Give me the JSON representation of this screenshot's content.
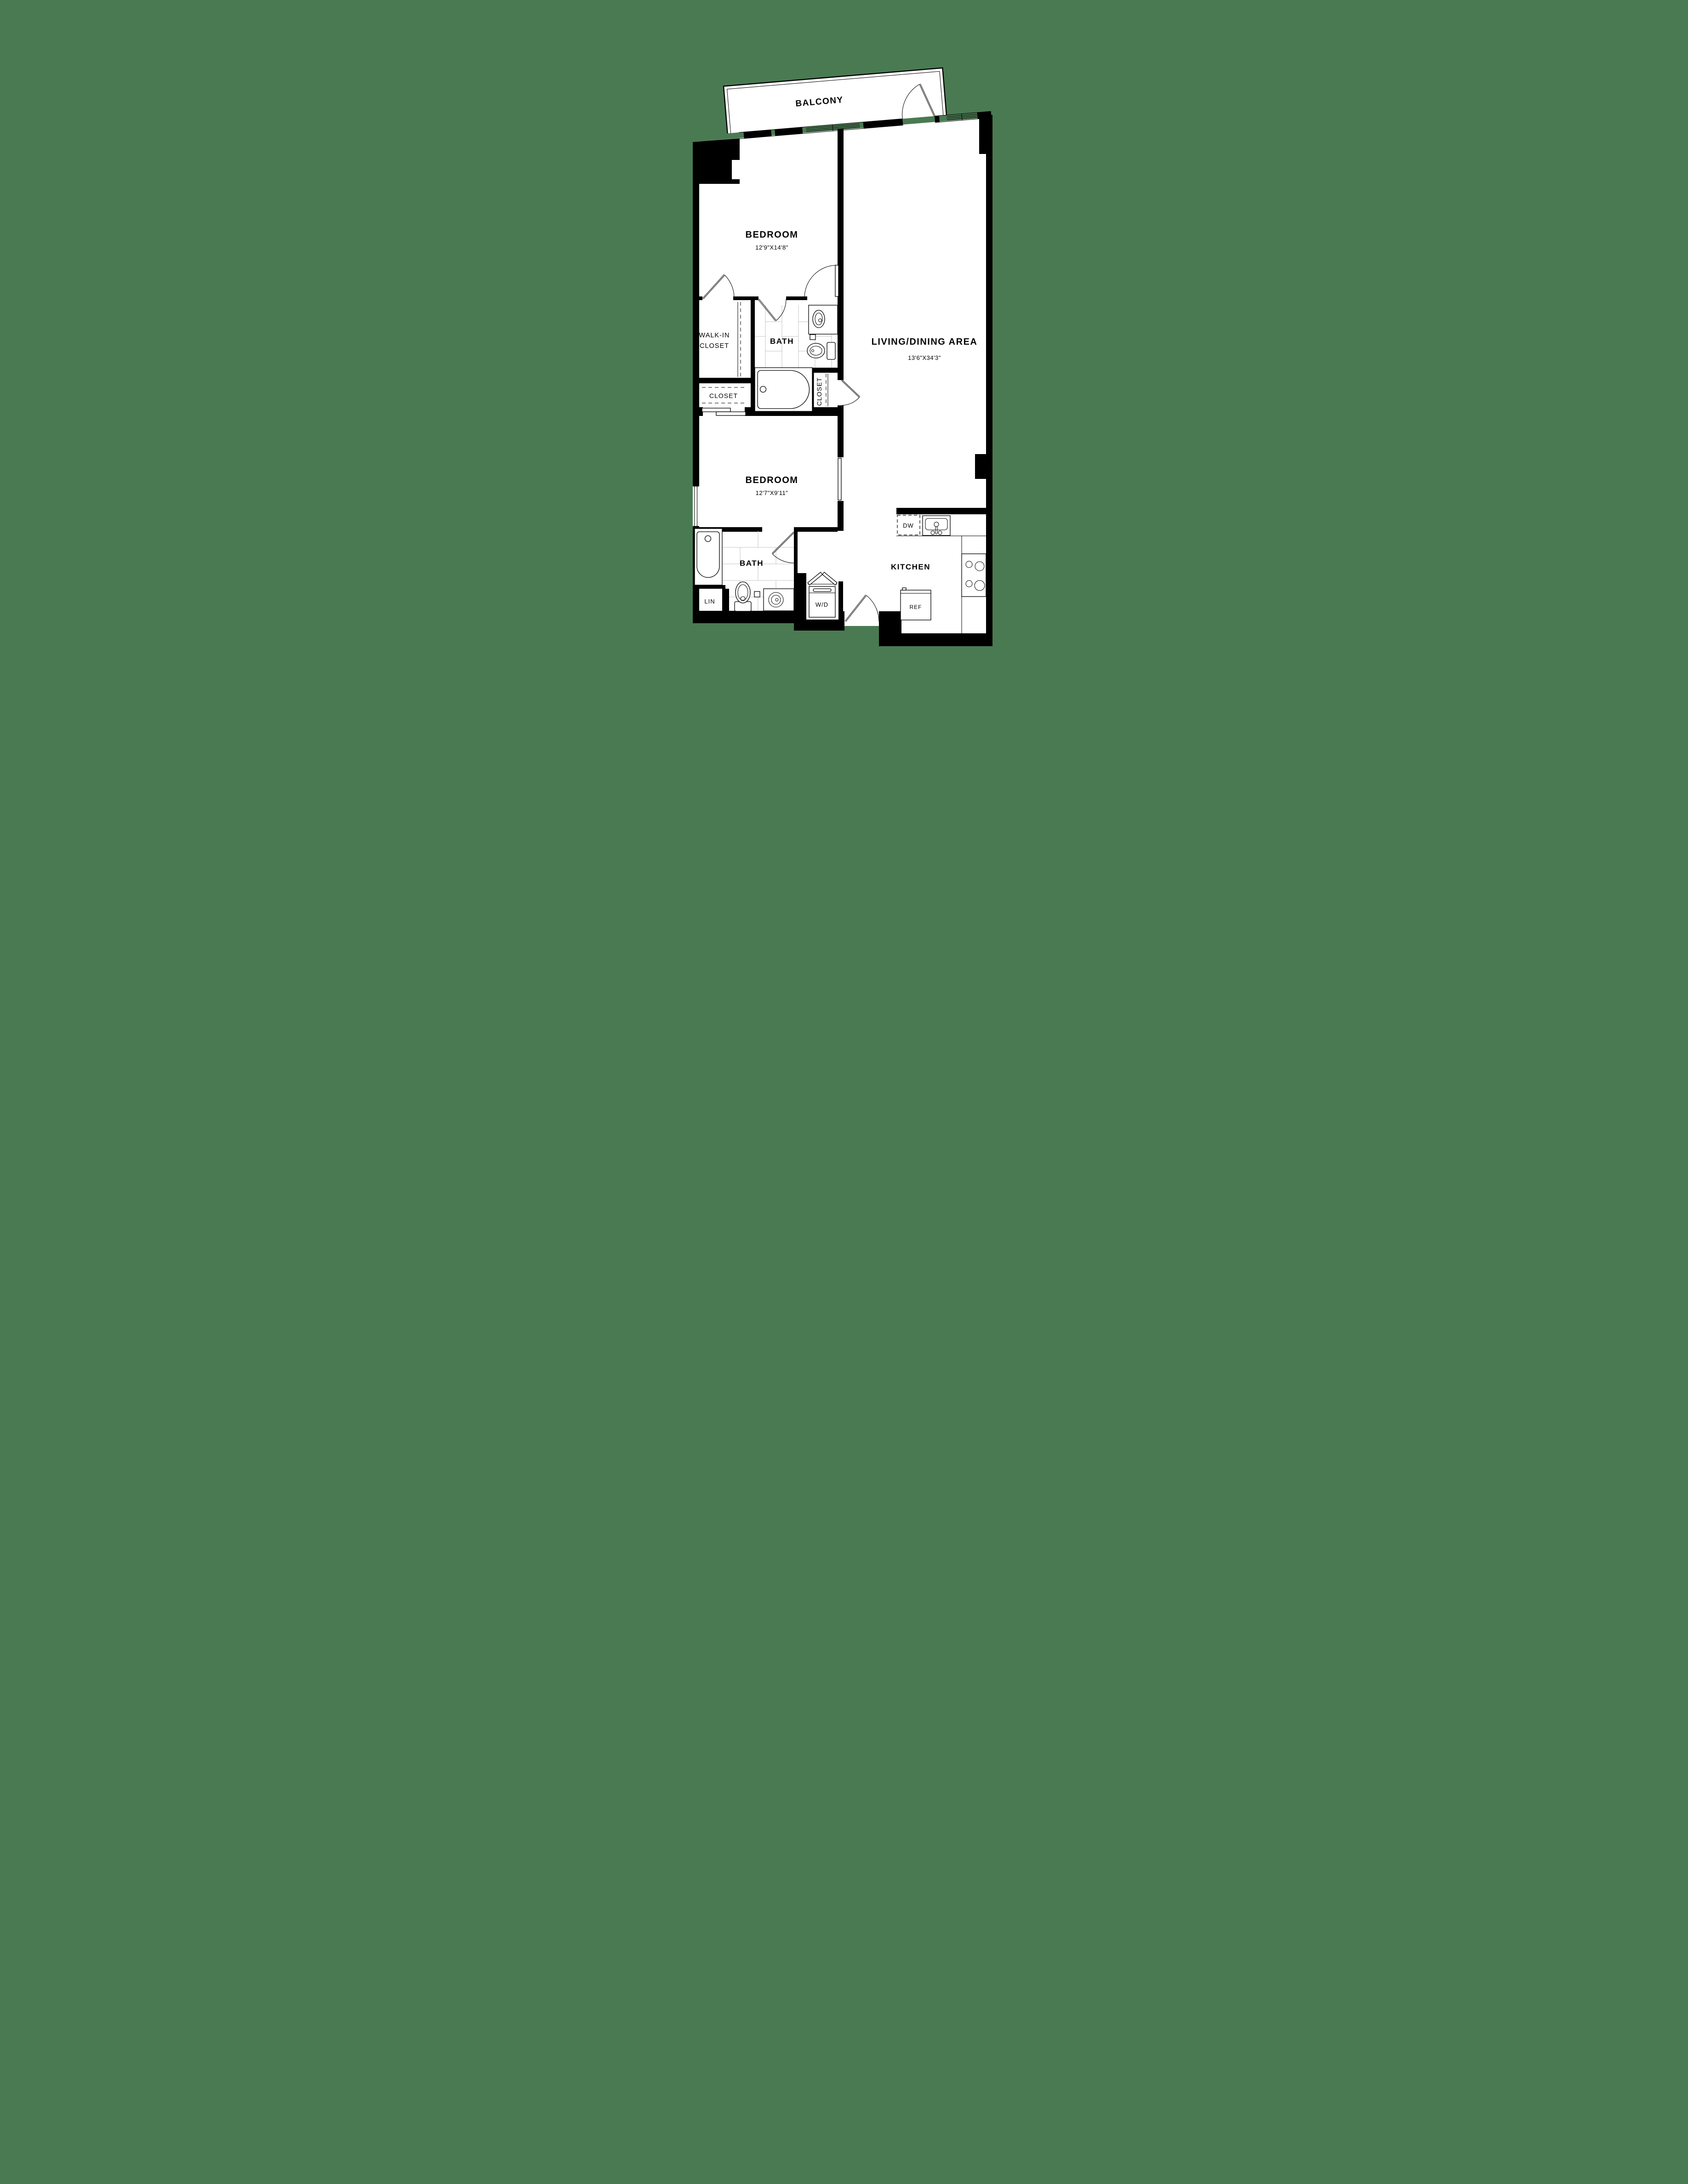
{
  "colors": {
    "background": "#4a7a52",
    "wall": "#000000",
    "floor": "#ffffff",
    "tile_line": "#c4c4c4"
  },
  "plan": {
    "balcony": {
      "label": "BALCONY"
    },
    "bedroom1": {
      "label": "BEDROOM",
      "dims": "12'9\"X14'8\""
    },
    "living": {
      "label": "LIVING/DINING AREA",
      "dims": "13'6\"X34'3\""
    },
    "walk_in_closet": {
      "line1": "WALK-IN",
      "line2": "CLOSET"
    },
    "bath1": {
      "label": "BATH"
    },
    "closet_small": {
      "label": "CLOSET"
    },
    "closet_mid": {
      "label": "CLOSET"
    },
    "bedroom2": {
      "label": "BEDROOM",
      "dims": "12'7\"X9'11\""
    },
    "bath2": {
      "label": "BATH"
    },
    "linen": {
      "label": "LIN"
    },
    "washer_dryer": {
      "label": "W/D"
    },
    "kitchen": {
      "label": "KITCHEN"
    },
    "dishwasher": {
      "label": "DW"
    },
    "refrigerator": {
      "label": "REF"
    }
  }
}
